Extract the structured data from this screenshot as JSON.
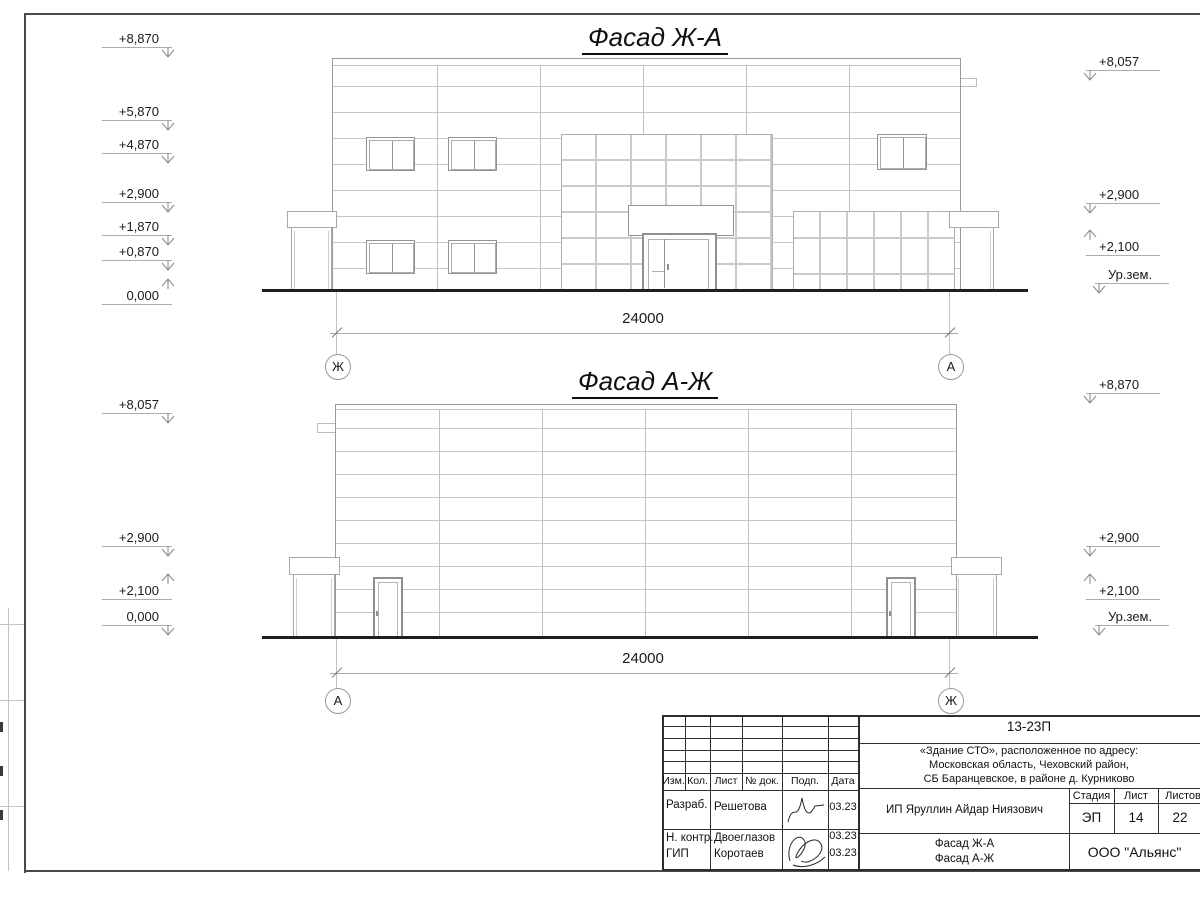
{
  "sheet": {
    "facade1": {
      "title": "Фасад Ж-А",
      "dim": "24000",
      "axis_left": "Ж",
      "axis_right": "А",
      "marks_left": [
        "+8,870",
        "+5,870",
        "+4,870",
        "+2,900",
        "+1,870",
        "+0,870",
        "0,000"
      ],
      "marks_right": [
        "+8,057",
        "+2,900",
        "+2,100",
        "Ур.зем."
      ]
    },
    "facade2": {
      "title": "Фасад А-Ж",
      "dim": "24000",
      "axis_left": "А",
      "axis_right": "Ж",
      "marks_left": [
        "+8,057",
        "+2,900",
        "+2,100",
        "0,000"
      ],
      "marks_right": [
        "+8,870",
        "+2,900",
        "+2,100",
        "Ур.зем."
      ]
    },
    "titleblock": {
      "code": "13-23П",
      "address": [
        "«Здание СТО», расположенное по адресу:",
        "Московская область, Чеховский район,",
        "СБ Баранцевское, в районе д. Курниково"
      ],
      "columns": [
        "Изм.",
        "Кол.",
        "Лист",
        "№ док.",
        "Подп.",
        "Дата"
      ],
      "rows": [
        {
          "role": "Разраб.",
          "name": "Решетова",
          "date": "03.23"
        },
        {
          "role": "Н. контр.",
          "name": "Двоеглазов",
          "date": "03.23"
        },
        {
          "role": "ГИП",
          "name": "Коротаев",
          "date": "03.23"
        }
      ],
      "client": "ИП Яруллин Айдар Ниязович",
      "stage_label": "Стадия",
      "sheet_label": "Лист",
      "sheets_label": "Листов",
      "stage": "ЭП",
      "sheet_no": "14",
      "sheets_total": "22",
      "content": [
        "Фасад Ж-А",
        "Фасад А-Ж"
      ],
      "company": "ООО \"Альянс\""
    }
  }
}
